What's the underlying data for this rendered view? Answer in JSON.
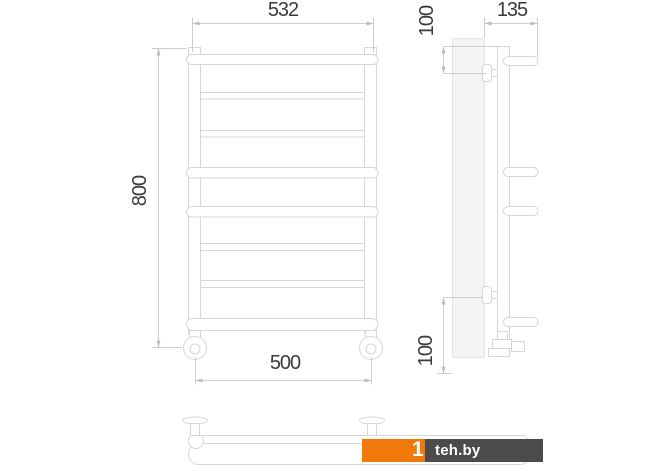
{
  "drawing": {
    "type": "ladder-towel-rail-technical-drawing",
    "views": [
      "front",
      "side",
      "bottom"
    ],
    "dimensions": {
      "top_width": "532",
      "height": "800",
      "bottom_width": "500",
      "depth": "135",
      "top_offset": "100",
      "bottom_offset": "100"
    }
  },
  "watermark": {
    "prefix": "1",
    "name": "teh.by"
  },
  "colors": {
    "line": "#d7d7d7",
    "dimension_line": "#cdcdcd",
    "arrow": "#bdbdbd",
    "text": "#3a3a3a",
    "wall_fill": "#f4f4f4",
    "logo_orange": "#F1790A",
    "logo_gray": "#4B4B4B",
    "logo_text": "#ffffff"
  }
}
